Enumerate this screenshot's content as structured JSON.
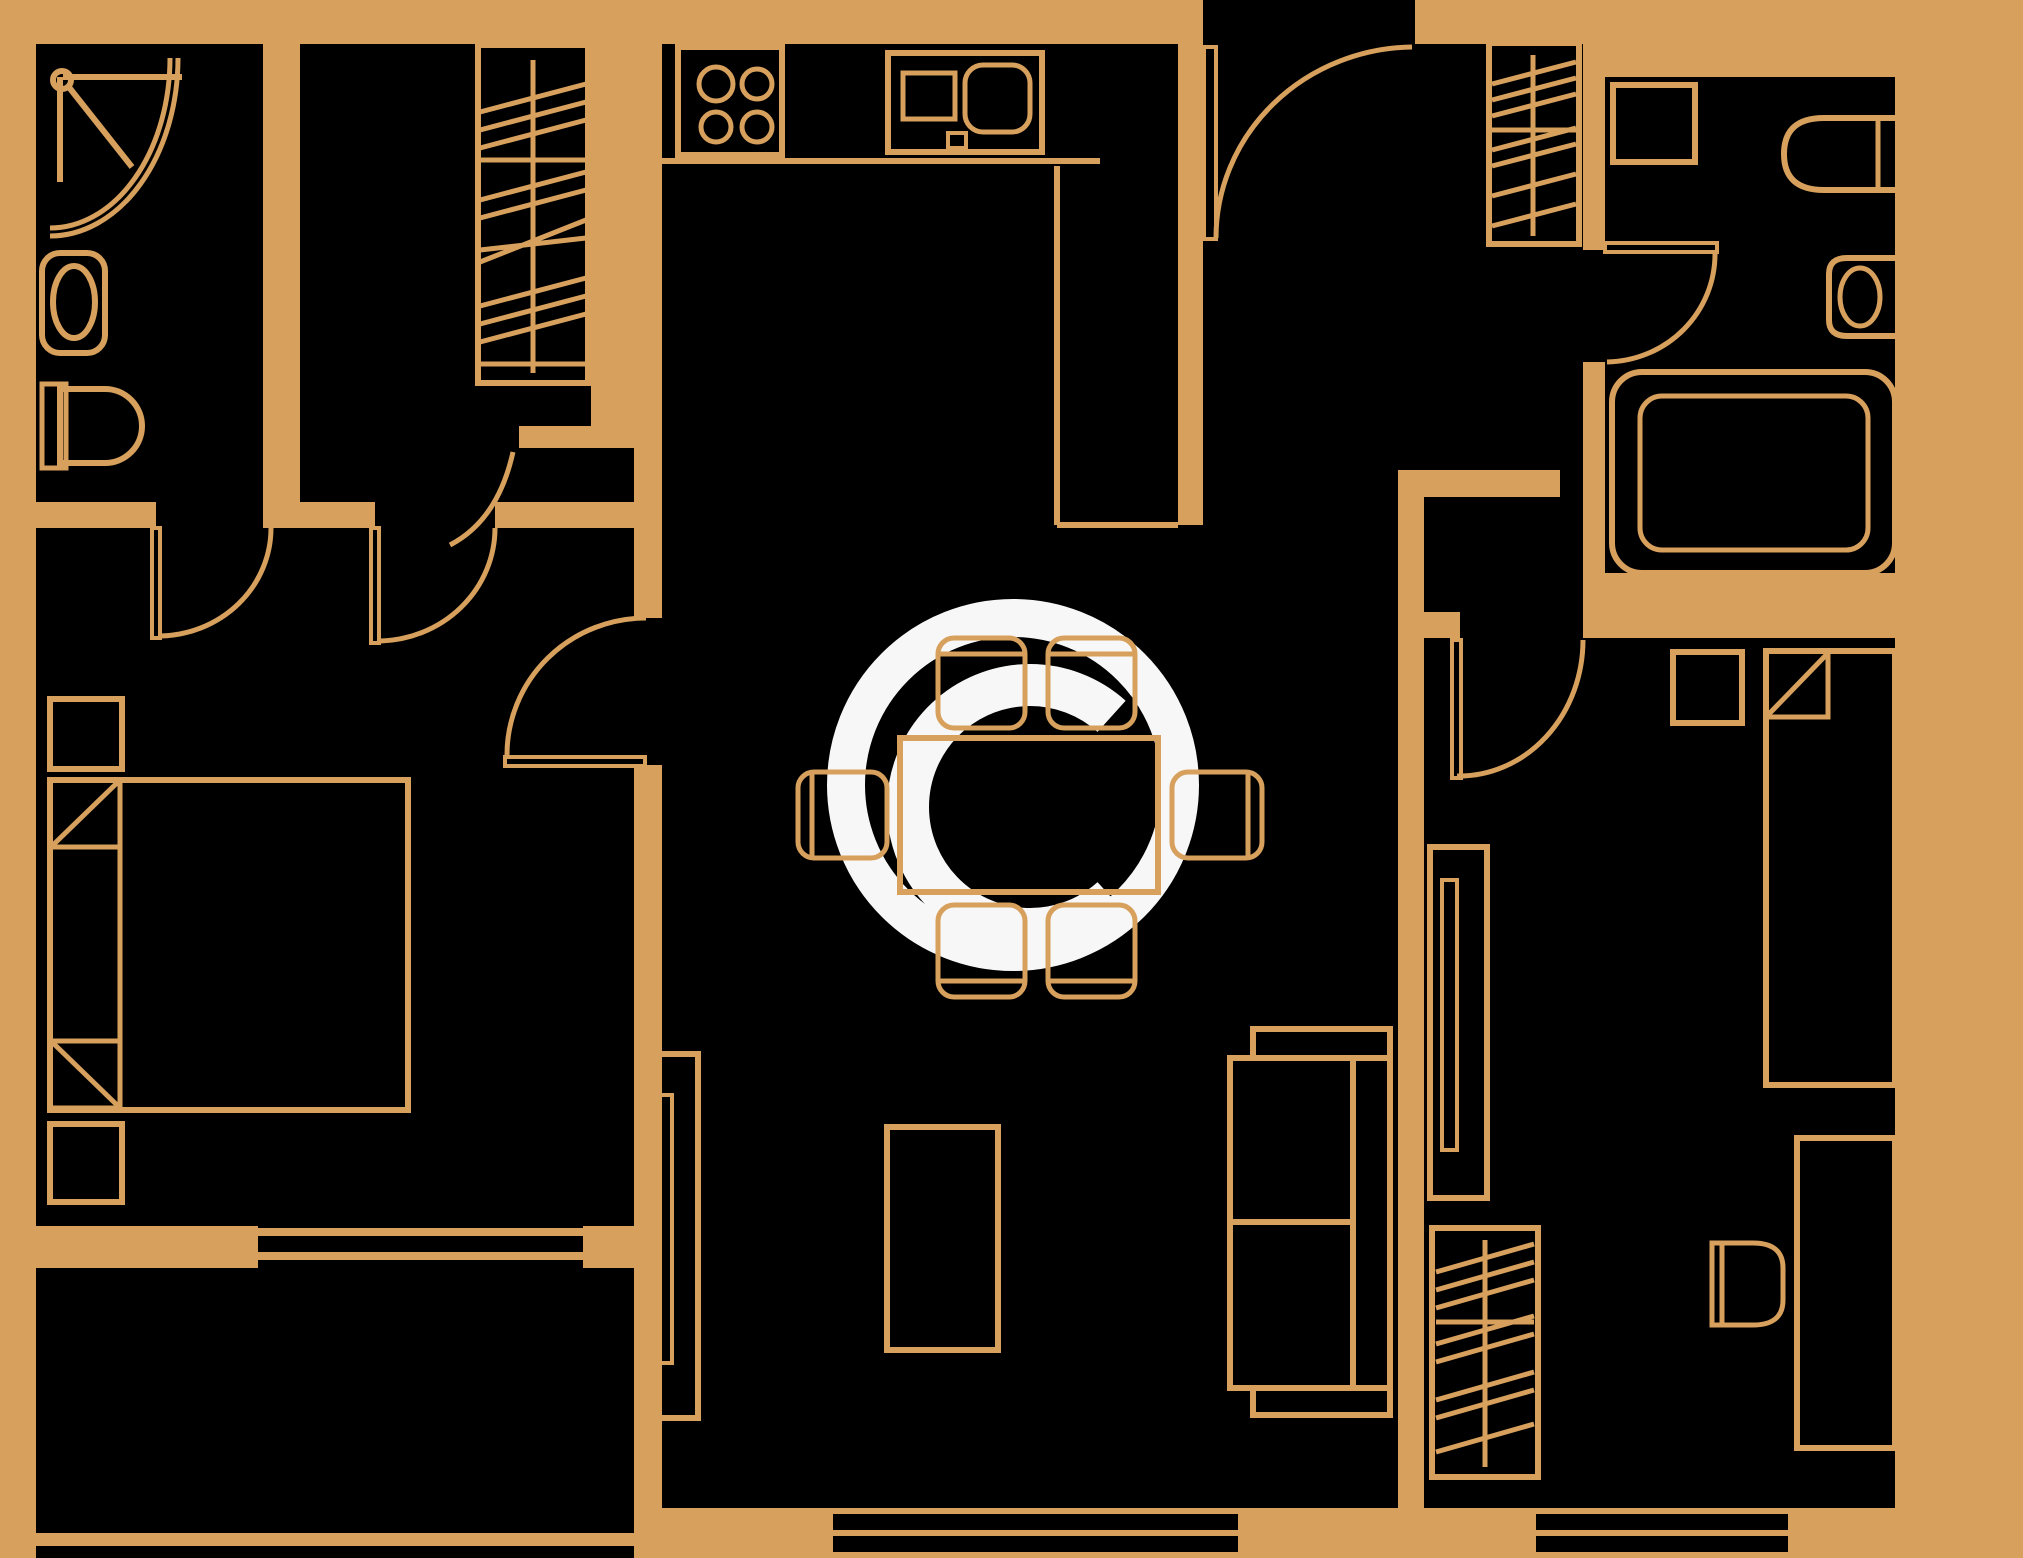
{
  "document": {
    "title": "apartment-floor-plan",
    "type": "architectural floor plan"
  },
  "canvas": {
    "width": 2023,
    "height": 1558
  },
  "colors": {
    "background": "#D7A05C",
    "wall": "#D7A05C",
    "line": "#D7A05C",
    "room_fill": "#000000",
    "watermark": "#F7F7F7"
  },
  "watermark": {
    "symbol": "©",
    "meaning": "copyright"
  },
  "rooms": [
    {
      "name": "bathroom-1",
      "fixtures": [
        "corner-shower",
        "wash-basin",
        "toilet"
      ]
    },
    {
      "name": "closet-room",
      "fixtures": [
        "wardrobe-hatched"
      ]
    },
    {
      "name": "kitchen",
      "fixtures": [
        "stove-4-burners",
        "kitchen-sink-unit",
        "counter-l-shape"
      ]
    },
    {
      "name": "entrance-hall",
      "fixtures": [
        "entrance-door",
        "wardrobe-hatched"
      ]
    },
    {
      "name": "bathroom-2",
      "fixtures": [
        "washing-machine",
        "toilet",
        "wash-basin",
        "bathtub",
        "door"
      ]
    },
    {
      "name": "bedroom-1",
      "fixtures": [
        "double-bed",
        "two-pillows",
        "nightstand",
        "nightstand",
        "door",
        "window"
      ]
    },
    {
      "name": "living-dining-room",
      "fixtures": [
        "dining-table",
        "six-chairs",
        "sofa",
        "coffee-table",
        "tv-unit",
        "window"
      ]
    },
    {
      "name": "bedroom-2",
      "fixtures": [
        "single-bed",
        "pillow",
        "nightstand",
        "tall-cabinet",
        "desk",
        "desk-chair",
        "wardrobe-hatched",
        "window",
        "door"
      ]
    },
    {
      "name": "balcony",
      "fixtures": [
        "railing"
      ]
    }
  ],
  "doors": [
    "entrance-door",
    "bathroom-1-door",
    "closet-room-door",
    "closet-kitchen-door",
    "bedroom-1-door",
    "bathroom-2-door",
    "bedroom-2-door"
  ],
  "windows": [
    "bedroom-1-window",
    "living-room-window",
    "bedroom-2-window"
  ]
}
